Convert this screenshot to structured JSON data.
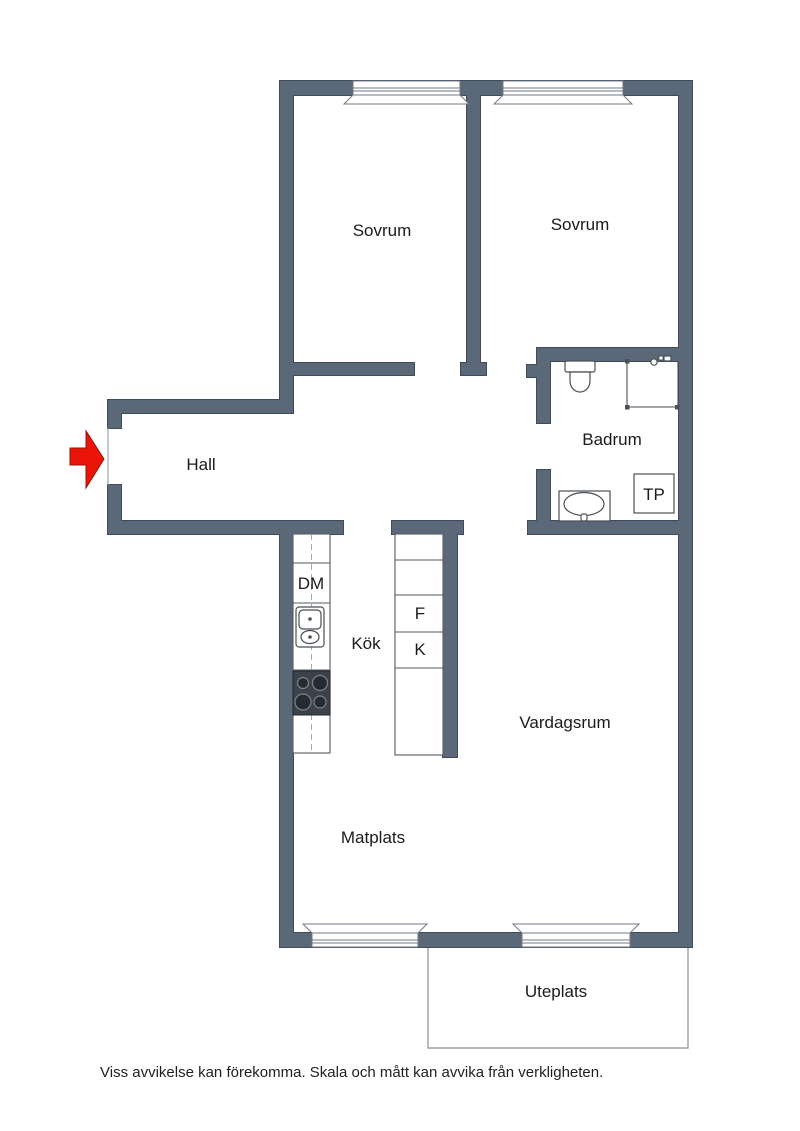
{
  "floorplan": {
    "rooms": [
      {
        "id": "sovrum-1",
        "label": "Sovrum"
      },
      {
        "id": "sovrum-2",
        "label": "Sovrum"
      },
      {
        "id": "badrum",
        "label": "Badrum"
      },
      {
        "id": "hall",
        "label": "Hall"
      },
      {
        "id": "kok",
        "label": "Kök"
      },
      {
        "id": "vardagsrum",
        "label": "Vardagsrum"
      },
      {
        "id": "matplats",
        "label": "Matplats"
      },
      {
        "id": "uteplats",
        "label": "Uteplats"
      }
    ],
    "fixtures": [
      {
        "id": "dishwasher",
        "label": "DM"
      },
      {
        "id": "fridge",
        "label": "F"
      },
      {
        "id": "freezer",
        "label": "K"
      },
      {
        "id": "laundry-tower",
        "label": "TP"
      }
    ],
    "colors": {
      "wall": "#5b6877",
      "wall_outline": "#3f4b5c",
      "entrance_arrow": "#ea1508"
    },
    "disclaimer": "Viss avvikelse kan förekomma. Skala och mått kan avvika från verkligheten."
  }
}
